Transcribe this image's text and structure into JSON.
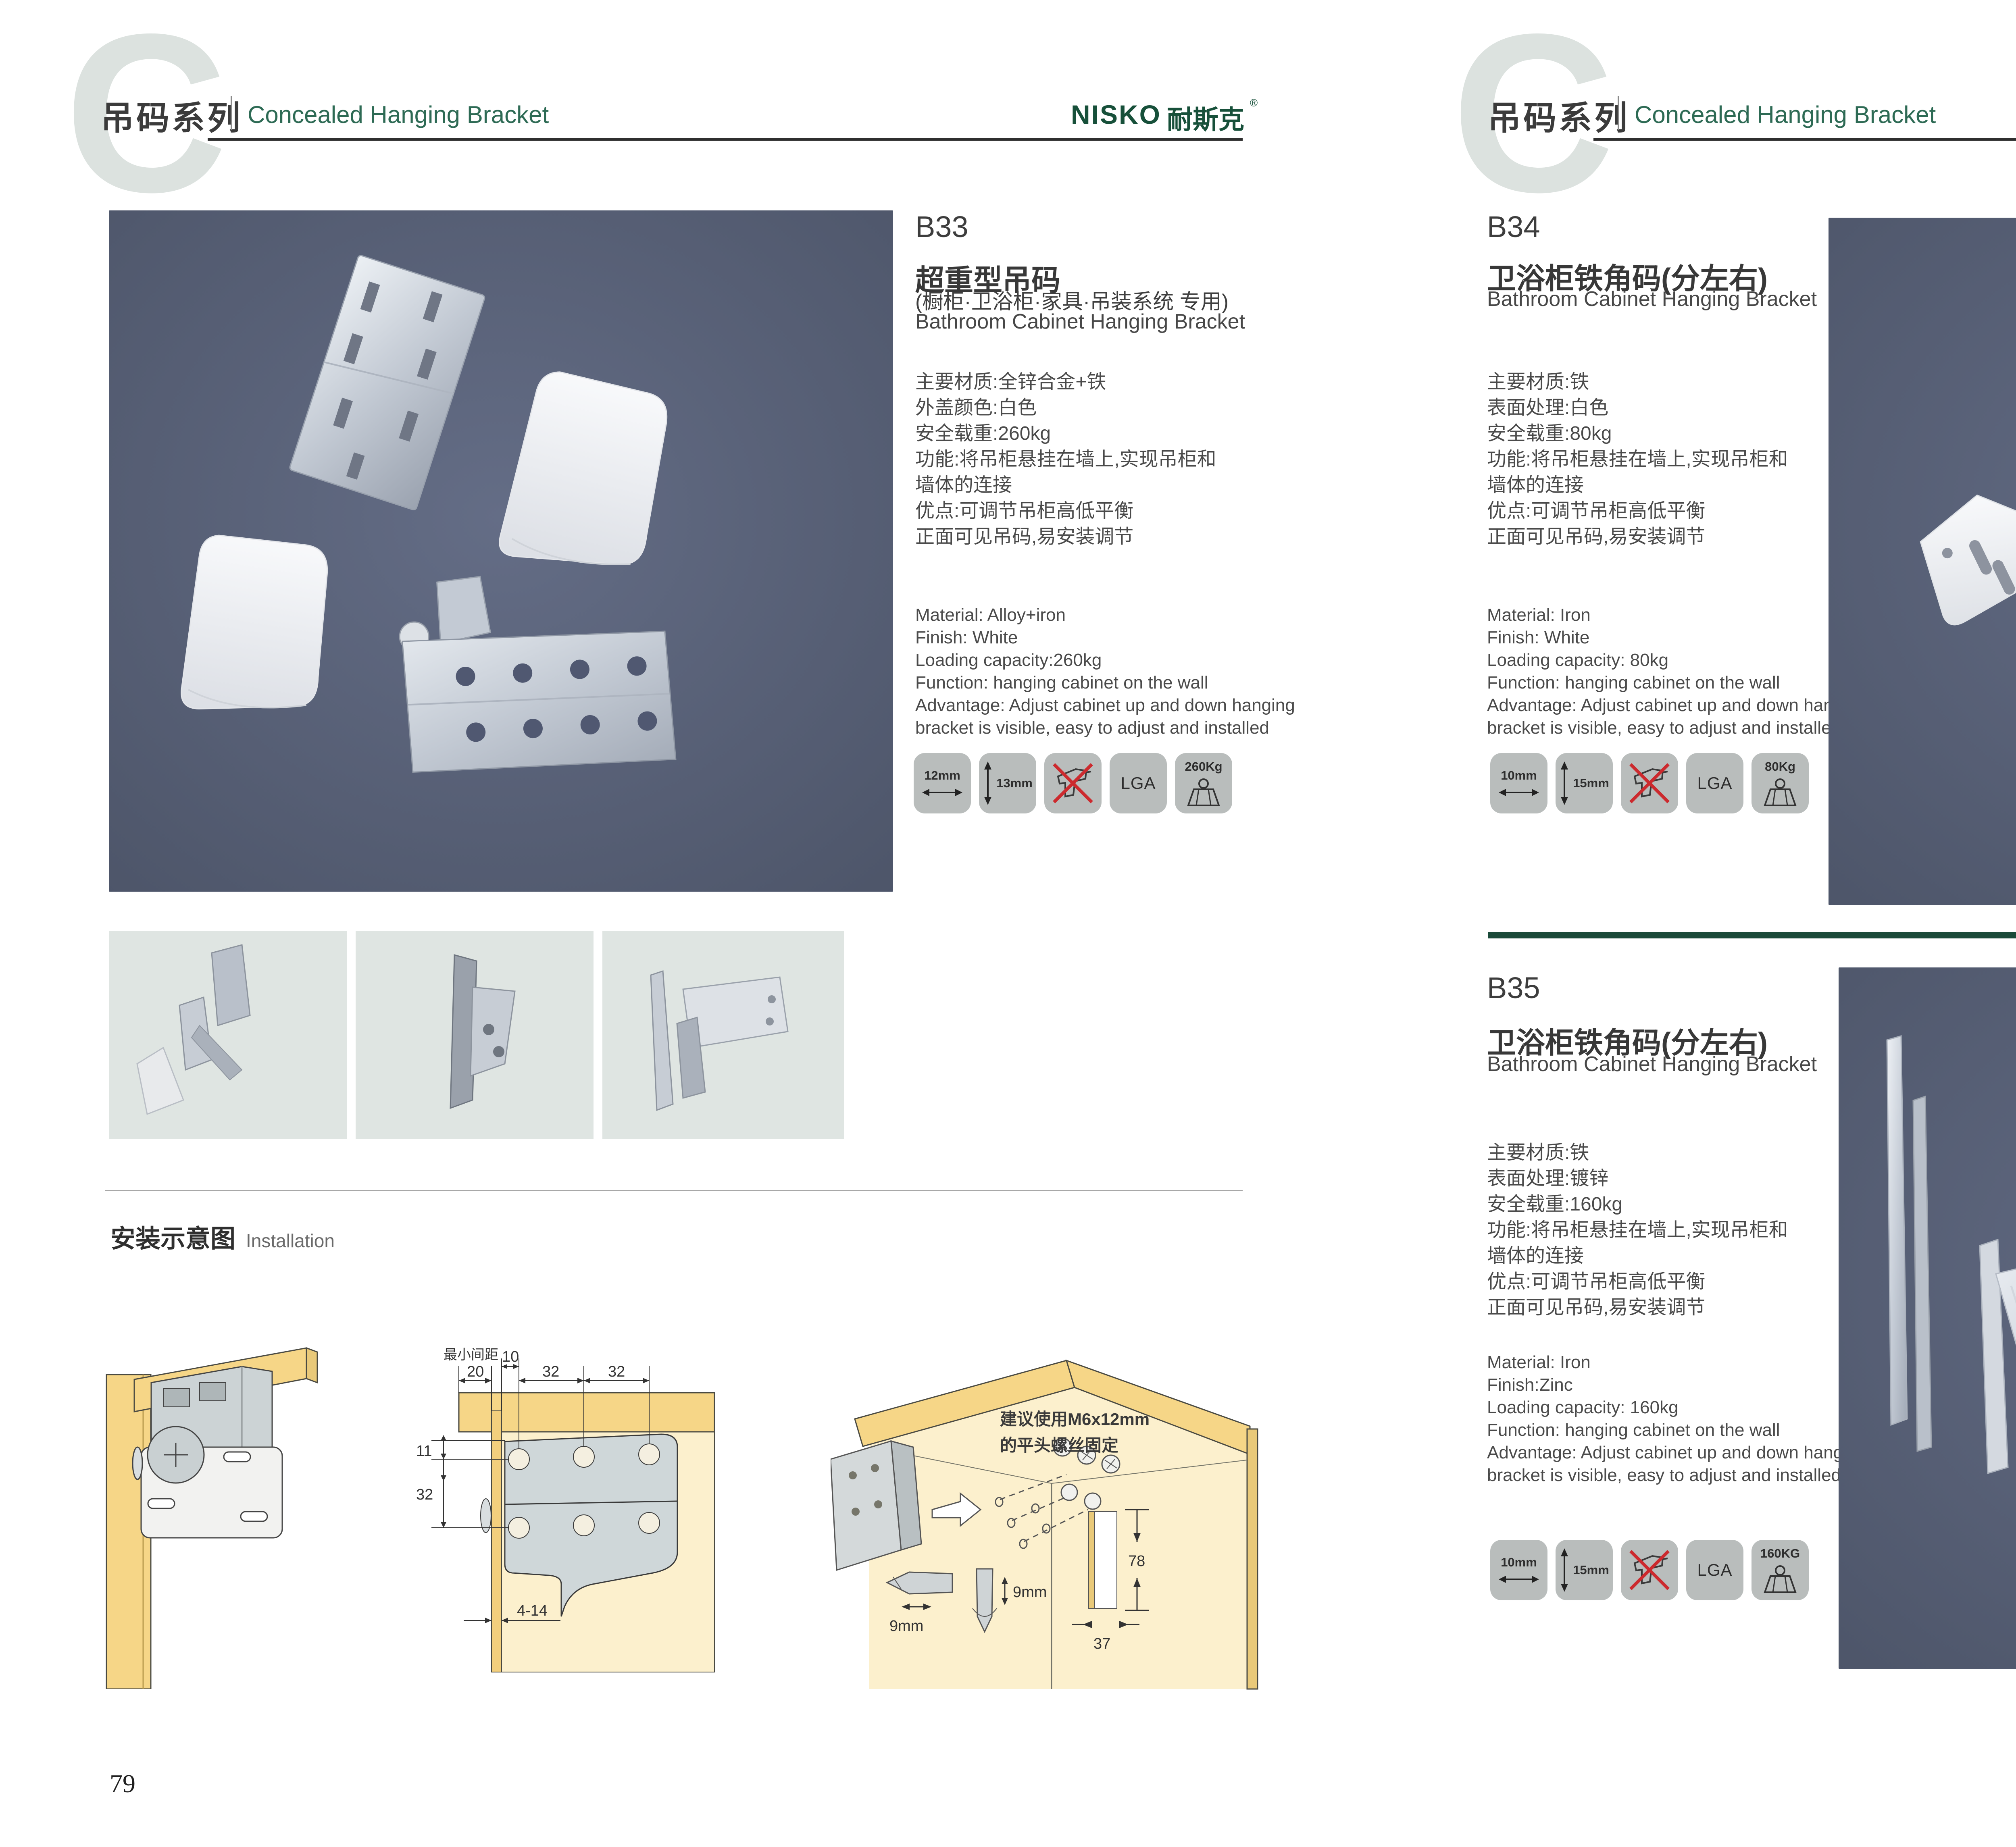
{
  "colors": {
    "header_green": "#2d6a54",
    "logo_green": "#17503a",
    "text_dark": "#3c3c3c",
    "photo_bg": "#59617a",
    "thumb_bg": "#dfe5e2",
    "badge_bg": "#b9bdbc",
    "divider_green": "#1b4a39",
    "divider_red": "#b3282b",
    "wood_yellow": "#f6d687",
    "wood_light": "#fcf0cd",
    "no_symbol_red": "#cc2a2e"
  },
  "page_left": {
    "header": {
      "watermark": "C",
      "series_cn": "吊码系列",
      "series_en": "Concealed Hanging Bracket",
      "logo_latin": "NISKO",
      "logo_cn": "耐斯克",
      "logo_reg": "®"
    },
    "product": {
      "code": "B33",
      "title_cn": "超重型吊码",
      "subtitle_cn": "(橱柜·卫浴柜·家具·吊装系统 专用)",
      "title_en": "Bathroom Cabinet Hanging Bracket",
      "specs_cn": "主要材质:全锌合金+铁\n外盖颜色:白色\n安全载重:260kg\n功能:将吊柜悬挂在墙上,实现吊柜和\n墙体的连接\n优点:可调节吊柜高低平衡\n正面可见吊码,易安装调节",
      "specs_en": "Material: Alloy+iron\nFinish: White\nLoading capacity:260kg\nFunction: hanging cabinet on the wall\nAdvantage: Adjust cabinet up and down hanging\nbracket is visible, easy to adjust and installed",
      "badges": {
        "width": "12mm",
        "height": "13mm",
        "cert": "LGA",
        "load": "260Kg"
      }
    },
    "installation": {
      "title_cn": "安装示意图",
      "title_en": "Installation",
      "diagram2": {
        "min_gap": "最小间距",
        "d20": "20",
        "d10": "10",
        "d32a": "32",
        "d32b": "32",
        "d11": "11",
        "d32": "32",
        "d4_14": "4-14"
      },
      "diagram3": {
        "note_line1": "建议使用M6x12mm",
        "note_line2": "的平头螺丝固定",
        "d78": "78",
        "d37": "37",
        "d9a": "9mm",
        "d9b": "9mm"
      }
    },
    "page_number": "79"
  },
  "page_right": {
    "header": {
      "watermark": "C",
      "series_cn": "吊码系列",
      "series_en": "Concealed Hanging Bracket",
      "logo_latin": "NISKO",
      "logo_cn": "耐斯克",
      "logo_reg": "®"
    },
    "product_top": {
      "code": "B34",
      "title_cn": "卫浴柜铁角码(分左右)",
      "title_en": "Bathroom Cabinet Hanging Bracket",
      "specs_cn": "主要材质:铁\n表面处理:白色\n安全载重:80kg\n功能:将吊柜悬挂在墙上,实现吊柜和\n墙体的连接\n优点:可调节吊柜高低平衡\n正面可见吊码,易安装调节",
      "specs_en": "Material: Iron\nFinish: White\nLoading capacity: 80kg\nFunction: hanging cabinet on the wall\nAdvantage: Adjust cabinet up and down hanging\nbracket is visible, easy to adjust and installed",
      "badges": {
        "width": "10mm",
        "height": "15mm",
        "cert": "LGA",
        "load": "80Kg"
      }
    },
    "product_bottom": {
      "code": "B35",
      "title_cn": "卫浴柜铁角码(分左右)",
      "title_en": "Bathroom Cabinet Hanging Bracket",
      "specs_cn": "主要材质:铁\n表面处理:镀锌\n安全载重:160kg\n功能:将吊柜悬挂在墙上,实现吊柜和\n墙体的连接\n优点:可调节吊柜高低平衡\n正面可见吊码,易安装调节",
      "specs_en": "Material: Iron\nFinish:Zinc\nLoading capacity: 160kg\nFunction: hanging cabinet on the wall\nAdvantage: Adjust cabinet up and down hanging\nbracket is visible, easy to adjust and installed",
      "badges": {
        "width": "10mm",
        "height": "15mm",
        "cert": "LGA",
        "load": "160KG"
      }
    },
    "page_number": "80"
  }
}
